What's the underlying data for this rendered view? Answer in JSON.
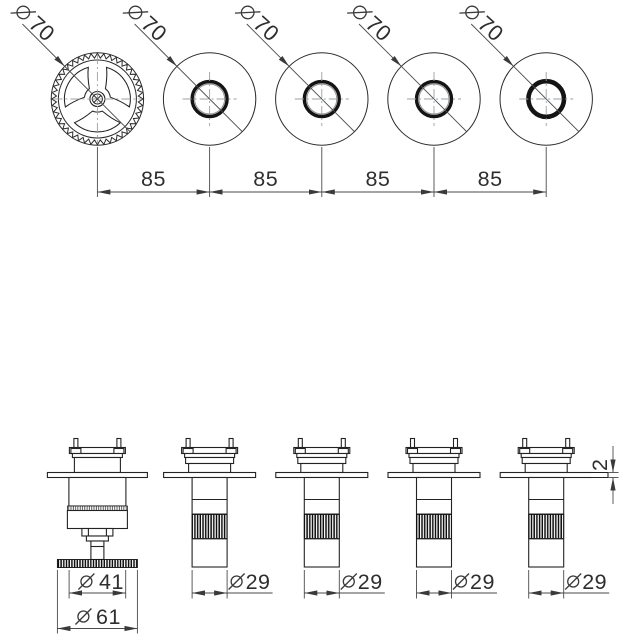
{
  "top_view": {
    "handles": [
      {
        "value": "70",
        "type": "wheel-handle"
      },
      {
        "value": "70",
        "type": "trim-ring"
      },
      {
        "value": "70",
        "type": "trim-ring"
      },
      {
        "value": "70",
        "type": "trim-ring"
      },
      {
        "value": "70",
        "type": "open-ring"
      }
    ],
    "spacings": [
      "85",
      "85",
      "85",
      "85"
    ]
  },
  "side_view": {
    "valve1": {
      "knob_diameter": "41",
      "wheel_diameter": "61"
    },
    "tube_diameters": [
      "29",
      "29",
      "29",
      "29"
    ],
    "plate_thickness": "2"
  },
  "symbols": {
    "diameter_sign": "⌀"
  },
  "colors": {
    "line": "#232323",
    "dimension": "#4a4a4a",
    "centerline": "#9aa0a6"
  }
}
